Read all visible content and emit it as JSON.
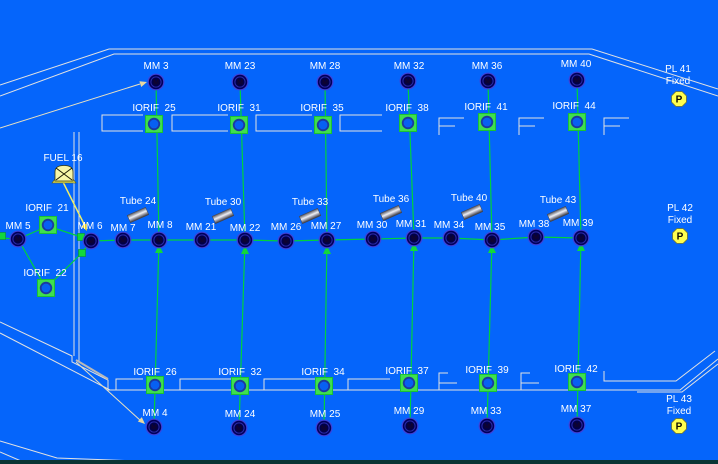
{
  "app": {
    "view": "flow-network-schematic"
  },
  "colors": {
    "background": "#0565fb",
    "pipe_green": "#00d23c",
    "component_green": "#3fdf4e",
    "node_navy": "#00005a",
    "structure_white": "#e2e2e2",
    "fuel_yellow": "#f6f6a8",
    "pressure_yellow": "#ffff4f",
    "label_text": "#ffffff",
    "bottom_bar": "#0a3434"
  },
  "icon_names": {
    "mm": "gauge-node-icon",
    "orifice": "orifice-node-icon",
    "tube": "tube-icon",
    "fuel": "fuel-tank-icon",
    "pressure": "pressure-node-icon",
    "flow_arrow": "flow-arrow-icon",
    "junction": "junction-node-icon"
  },
  "network": {
    "top_row_mm": [
      "MM 3",
      "MM 23",
      "MM 28",
      "MM 32",
      "MM 36",
      "MM 40"
    ],
    "top_row_orifices": [
      "IORIF  25",
      "IORIF  31",
      "IORIF  35",
      "IORIF  38",
      "IORIF  41",
      "IORIF  44"
    ],
    "mid_row_mm_left": "MM 5",
    "mid_row_mm": [
      "MM 6",
      "MM 7",
      "MM 8",
      "MM 21",
      "MM 22",
      "MM 26",
      "MM 27",
      "MM 30",
      "MM 31",
      "MM 34",
      "MM 35",
      "MM 38",
      "MM 39"
    ],
    "tubes": [
      "Tube 24",
      "Tube 30",
      "Tube 33",
      "Tube 36",
      "Tube 40",
      "Tube 43"
    ],
    "left_branch": {
      "orifice_top": "IORIF  21",
      "orifice_bottom": "IORIF  22"
    },
    "fuel_component": "FUEL 16",
    "bottom_row_orifices": [
      "IORIF  26",
      "IORIF  32",
      "IORIF  34",
      "IORIF  37",
      "IORIF  39",
      "IORIF  42"
    ],
    "bottom_row_mm": [
      "MM 4",
      "MM 24",
      "MM 25",
      "MM 29",
      "MM 33",
      "MM 37"
    ],
    "pressure_nodes": [
      {
        "name": "PL 41",
        "state": "Fixed"
      },
      {
        "name": "PL 42",
        "state": "Fixed"
      },
      {
        "name": "PL 43",
        "state": "Fixed"
      }
    ]
  }
}
